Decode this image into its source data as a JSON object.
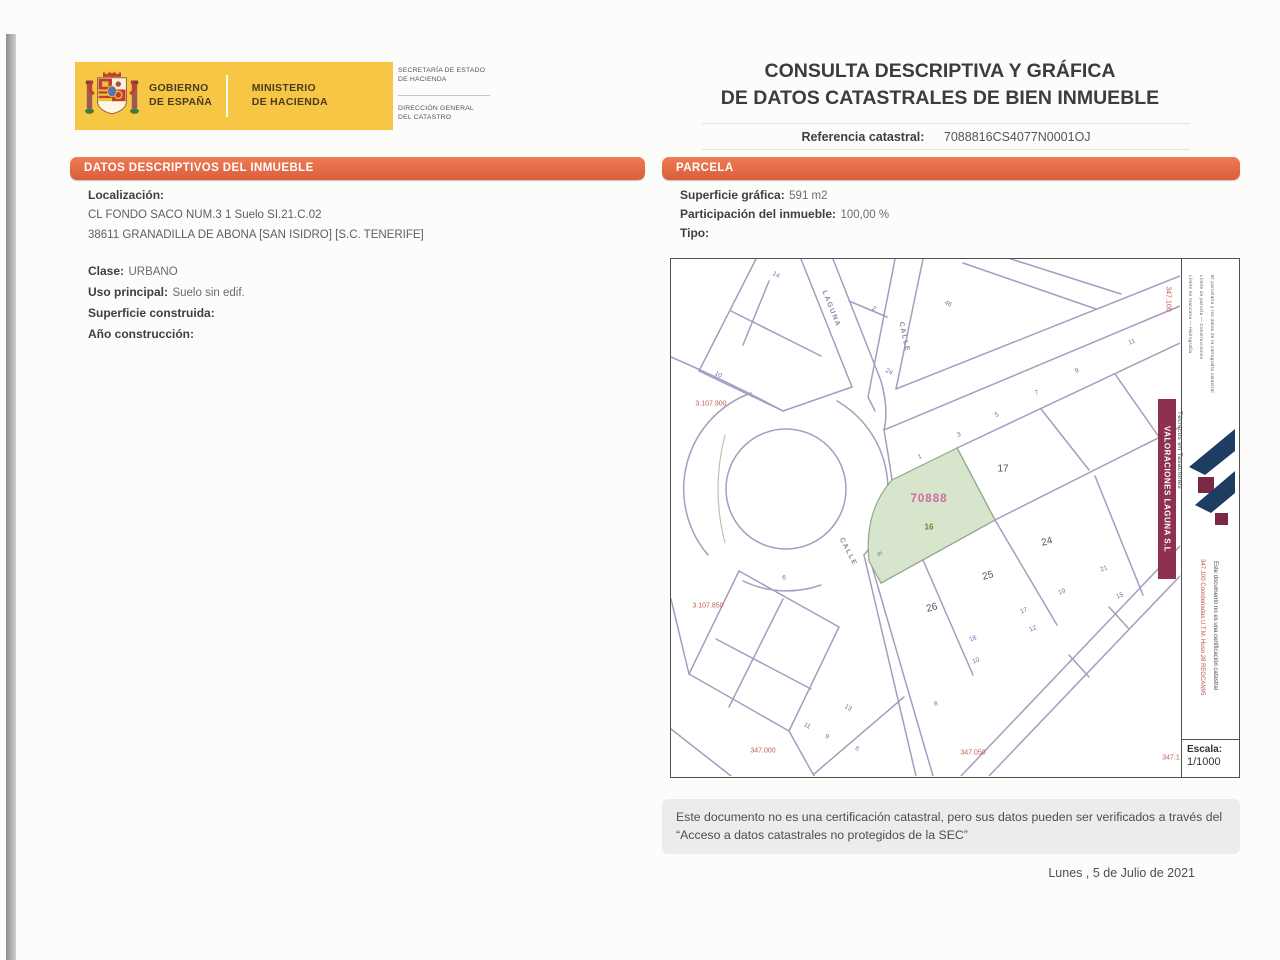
{
  "header": {
    "gov_line1": "GOBIERNO",
    "gov_line2": "DE ESPAÑA",
    "min_line1": "MINISTERIO",
    "min_line2": "DE HACIENDA",
    "secretaria_line1": "SECRETARÍA DE ESTADO",
    "secretaria_line2": "DE HACIENDA",
    "direccion_line1": "DIRECCIÓN GENERAL",
    "direccion_line2": "DEL CATASTRO",
    "title_line1": "CONSULTA DESCRIPTIVA Y GRÁFICA",
    "title_line2": "DE DATOS CATASTRALES DE BIEN INMUEBLE",
    "ref_label": "Referencia catastral:",
    "ref_value": "7088816CS4077N0001OJ"
  },
  "datos": {
    "section_title": "DATOS DESCRIPTIVOS DEL INMUEBLE",
    "localizacion_label": "Localización:",
    "address_line1": "CL FONDO SACO NUM.3 1 Suelo SI.21.C.02",
    "address_line2": "38611 GRANADILLA DE ABONA [SAN ISIDRO] [S.C. TENERIFE]",
    "clase_label": "Clase:",
    "clase_value": "URBANO",
    "uso_label": "Uso principal:",
    "uso_value": "Suelo sin edif.",
    "superficie_label": "Superficie construida:",
    "superficie_value": "",
    "anio_label": "Año construcción:",
    "anio_value": ""
  },
  "parcela": {
    "section_title": "PARCELA",
    "superficie_label": "Superficie gráfica:",
    "superficie_value": "591 m2",
    "participacion_label": "Participación del inmueble:",
    "participacion_value": "100,00 %",
    "tipo_label": "Tipo:",
    "tipo_value": ""
  },
  "map": {
    "scale_label": "Escala:",
    "scale_value": "1/1000",
    "company_banner": "VALORACIONES LAGUNA S.L",
    "company_sub": "Técnicos en Tasaciones",
    "coord_note": "347.100 Coordenadas U.T.M. Huso 28 REGCAN95",
    "margin_note": "Este documento no es una certificación catastral",
    "fine_print": [
      "Límite de manzana — Hidrografía",
      "Límite de parcela — Construcciones",
      "El parcelario y los datos de la cartografía catastral"
    ],
    "colors": {
      "street_line": "#a89bc0",
      "parcel_fill": "#d6e5cb",
      "parcel_stroke": "#8fa98b",
      "accent_orange": "#e06a45",
      "banner_maroon": "#8e3050",
      "logo_navy": "#1d3d63"
    },
    "labels": [
      {
        "t": "LAGUNA",
        "x": 160,
        "y": 50,
        "c": "st",
        "r": 68
      },
      {
        "t": "CALLE",
        "x": 233,
        "y": 78,
        "c": "st",
        "r": 78
      },
      {
        "t": "CALLE",
        "x": 177,
        "y": 293,
        "c": "st",
        "r": 63
      },
      {
        "t": "17",
        "x": 332,
        "y": 210,
        "c": "pn",
        "r": 0
      },
      {
        "t": "24",
        "x": 376,
        "y": 283,
        "c": "pn",
        "r": -15
      },
      {
        "t": "25",
        "x": 317,
        "y": 317,
        "c": "pn",
        "r": -15
      },
      {
        "t": "26",
        "x": 261,
        "y": 349,
        "c": "pn",
        "r": -15
      },
      {
        "t": "70888",
        "x": 258,
        "y": 240,
        "c": "pk",
        "r": 0
      },
      {
        "t": "16",
        "x": 258,
        "y": 268,
        "c": "ol",
        "r": 0
      },
      {
        "t": "3.107.900",
        "x": 40,
        "y": 145,
        "c": "rc",
        "r": 0
      },
      {
        "t": "3.107.850",
        "x": 37,
        "y": 347,
        "c": "rc",
        "r": 0
      },
      {
        "t": "347.000",
        "x": 92,
        "y": 492,
        "c": "rc",
        "r": 0
      },
      {
        "t": "347.050",
        "x": 302,
        "y": 494,
        "c": "rc",
        "r": 0
      },
      {
        "t": "347.1",
        "x": 500,
        "y": 499,
        "c": "rc",
        "r": 0
      },
      {
        "t": "347.100",
        "x": 497,
        "y": 40,
        "c": "rc",
        "r": 90
      },
      {
        "t": "14",
        "x": 105,
        "y": 16,
        "c": "hn",
        "r": 30
      },
      {
        "t": "2",
        "x": 203,
        "y": 50,
        "c": "hn",
        "r": 30
      },
      {
        "t": "24",
        "x": 218,
        "y": 113,
        "c": "hn",
        "r": 30
      },
      {
        "t": "46",
        "x": 277,
        "y": 45,
        "c": "hn",
        "r": 30
      },
      {
        "t": "10",
        "x": 47,
        "y": 116,
        "c": "hn",
        "r": 30
      },
      {
        "t": "11",
        "x": 461,
        "y": 83,
        "c": "hn",
        "r": -23
      },
      {
        "t": "9",
        "x": 406,
        "y": 112,
        "c": "hn",
        "r": -23
      },
      {
        "t": "7",
        "x": 366,
        "y": 134,
        "c": "hn",
        "r": -23
      },
      {
        "t": "5",
        "x": 326,
        "y": 156,
        "c": "hn",
        "r": -23
      },
      {
        "t": "3",
        "x": 288,
        "y": 176,
        "c": "hn",
        "r": -23
      },
      {
        "t": "1",
        "x": 249,
        "y": 198,
        "c": "hn",
        "r": -23
      },
      {
        "t": "21",
        "x": 433,
        "y": 310,
        "c": "hn",
        "r": -23
      },
      {
        "t": "19",
        "x": 391,
        "y": 333,
        "c": "hn",
        "r": -23
      },
      {
        "t": "15",
        "x": 449,
        "y": 337,
        "c": "hn",
        "r": -23
      },
      {
        "t": "17",
        "x": 353,
        "y": 352,
        "c": "hn",
        "r": -23
      },
      {
        "t": "12",
        "x": 362,
        "y": 370,
        "c": "hn",
        "r": -23
      },
      {
        "t": "18",
        "x": 302,
        "y": 380,
        "c": "hn",
        "r": -23
      },
      {
        "t": "10",
        "x": 305,
        "y": 402,
        "c": "hn",
        "r": -23
      },
      {
        "t": "8",
        "x": 265,
        "y": 445,
        "c": "hn",
        "r": -23
      },
      {
        "t": "8",
        "x": 208,
        "y": 295,
        "c": "hn",
        "r": 60
      },
      {
        "t": "6",
        "x": 113,
        "y": 319,
        "c": "hn",
        "r": 0
      },
      {
        "t": "13",
        "x": 177,
        "y": 449,
        "c": "hn",
        "r": 30
      },
      {
        "t": "11",
        "x": 136,
        "y": 467,
        "c": "hn",
        "r": 30
      },
      {
        "t": "9",
        "x": 156,
        "y": 478,
        "c": "hn",
        "r": 30
      },
      {
        "t": "6",
        "x": 186,
        "y": 490,
        "c": "hn",
        "r": 30
      }
    ]
  },
  "footer": {
    "disclaimer": "Este documento no es una certificación catastral, pero sus datos pueden ser verificados a través del “Acceso a datos catastrales no protegidos de la SEC”",
    "date": "Lunes , 5 de Julio de 2021"
  }
}
